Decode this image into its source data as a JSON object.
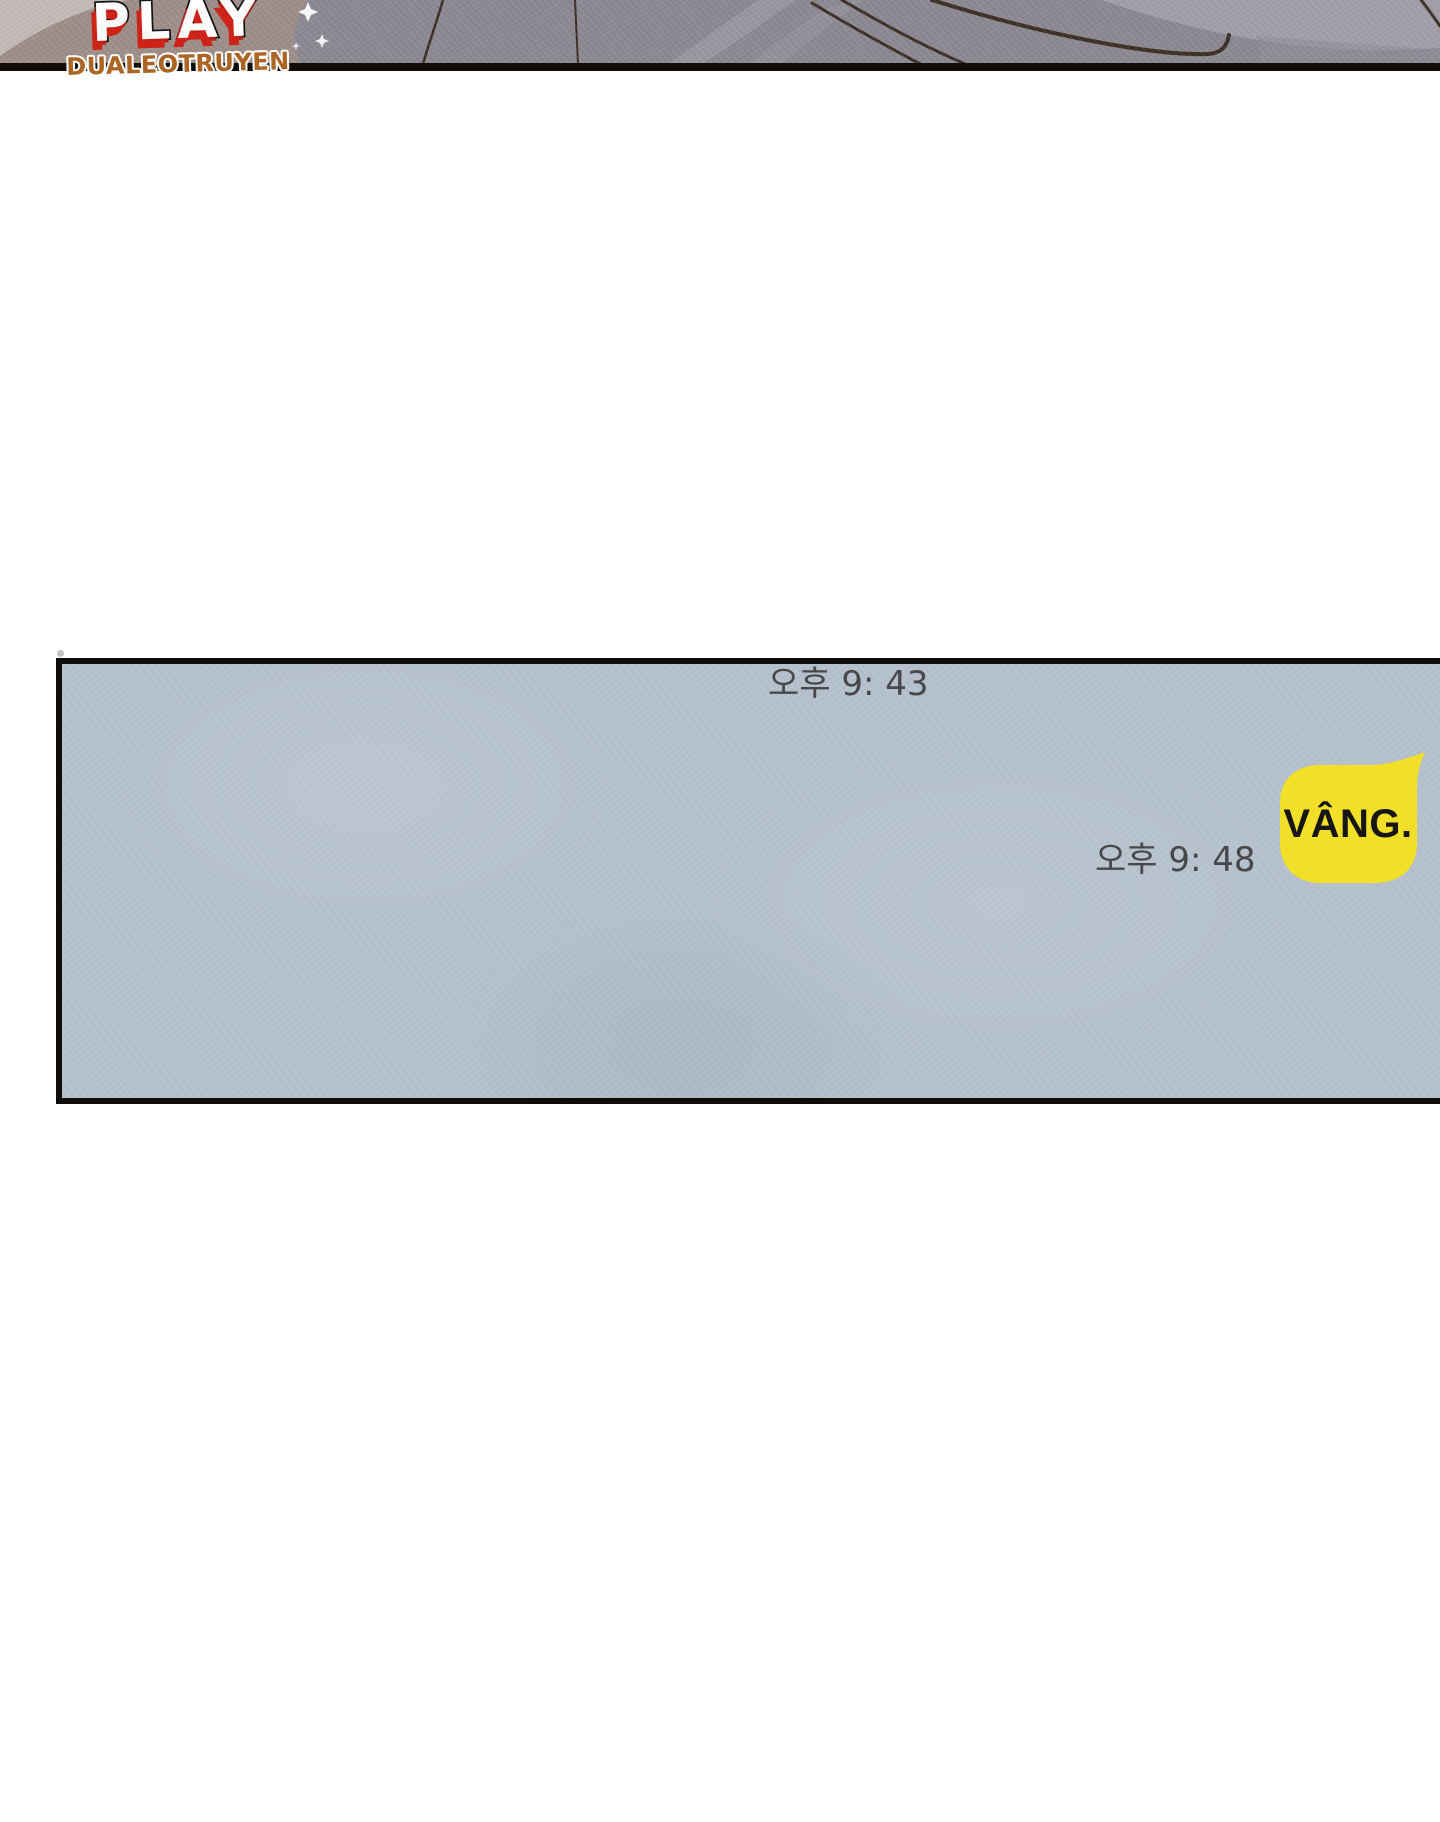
{
  "watermark": {
    "line1": "PLAY",
    "line2": "DUALEOTRUYEN"
  },
  "panel": {
    "timestamp_1": "오후 9: 43",
    "timestamp_2": "오후 9: 48",
    "bubble_text": "VÂNG."
  },
  "colors": {
    "page_background": "#ffffff",
    "band_gray": "#8b8892",
    "band_taupe": "#9e8e89",
    "band_highlight": "#a6a3ad",
    "band_line_brown": "#3c2f24",
    "band_border_black": "#100d0b",
    "logo_white": "#ffffff",
    "logo_red": "#cd2318",
    "logo_orange": "#ad6524",
    "panel_background": "#b4c0cb",
    "panel_border": "#0e0d0c",
    "timestamp_text": "#47474c",
    "bubble_yellow": "#f2df28",
    "bubble_text": "#161616"
  }
}
